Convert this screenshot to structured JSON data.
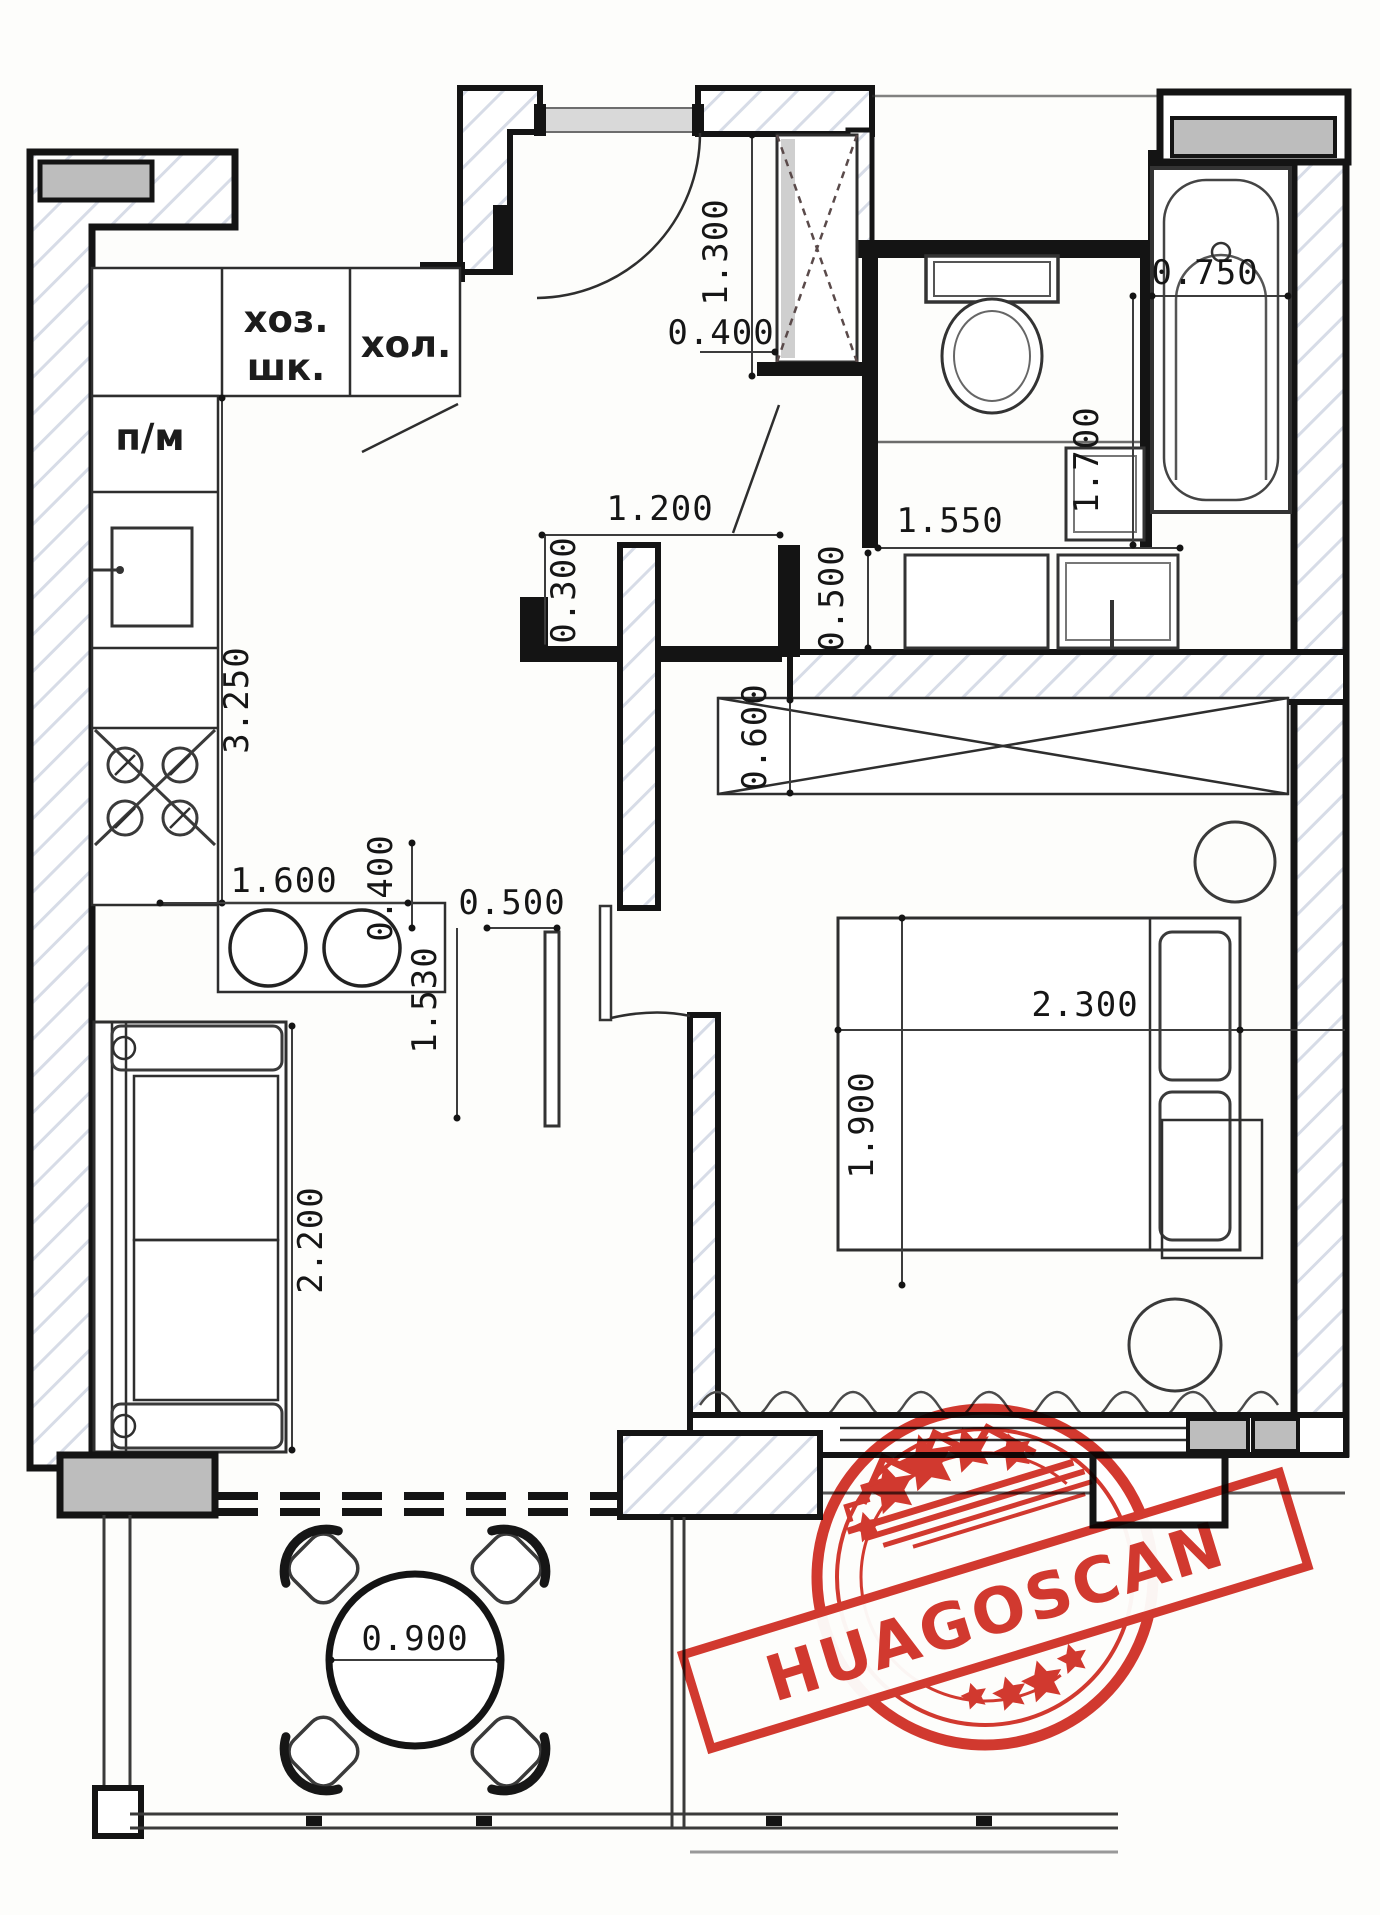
{
  "rooms": {
    "utility_closet_line1": "хоз.",
    "utility_closet_line2": "шк.",
    "fridge": "хол.",
    "dishwasher": "п/м"
  },
  "dims": {
    "closet_h": "1.300",
    "closet_d": "0.400",
    "tub_w": "0.750",
    "tub_l": "1.700",
    "wc_w": "1.550",
    "vanity_d": "0.500",
    "hall_w": "1.200",
    "hall_nib": "0.300",
    "counter_l": "3.250",
    "counter_end": "1.600",
    "wardrobe_d": "0.600",
    "bed_l": "2.300",
    "bed_w": "1.900",
    "tv_gap": "0.400",
    "tv_w": "0.500",
    "tv_l": "1.530",
    "sofa_l": "2.200",
    "table_d": "0.900"
  },
  "stamp": {
    "text": "HUAGOSCAN"
  },
  "colors": {
    "paper": "#fdfdfb",
    "line": "#141414",
    "hatch": "#b6c0d4",
    "wall_gray": "#bdbdbd",
    "stamp_red": "#cf2318"
  }
}
